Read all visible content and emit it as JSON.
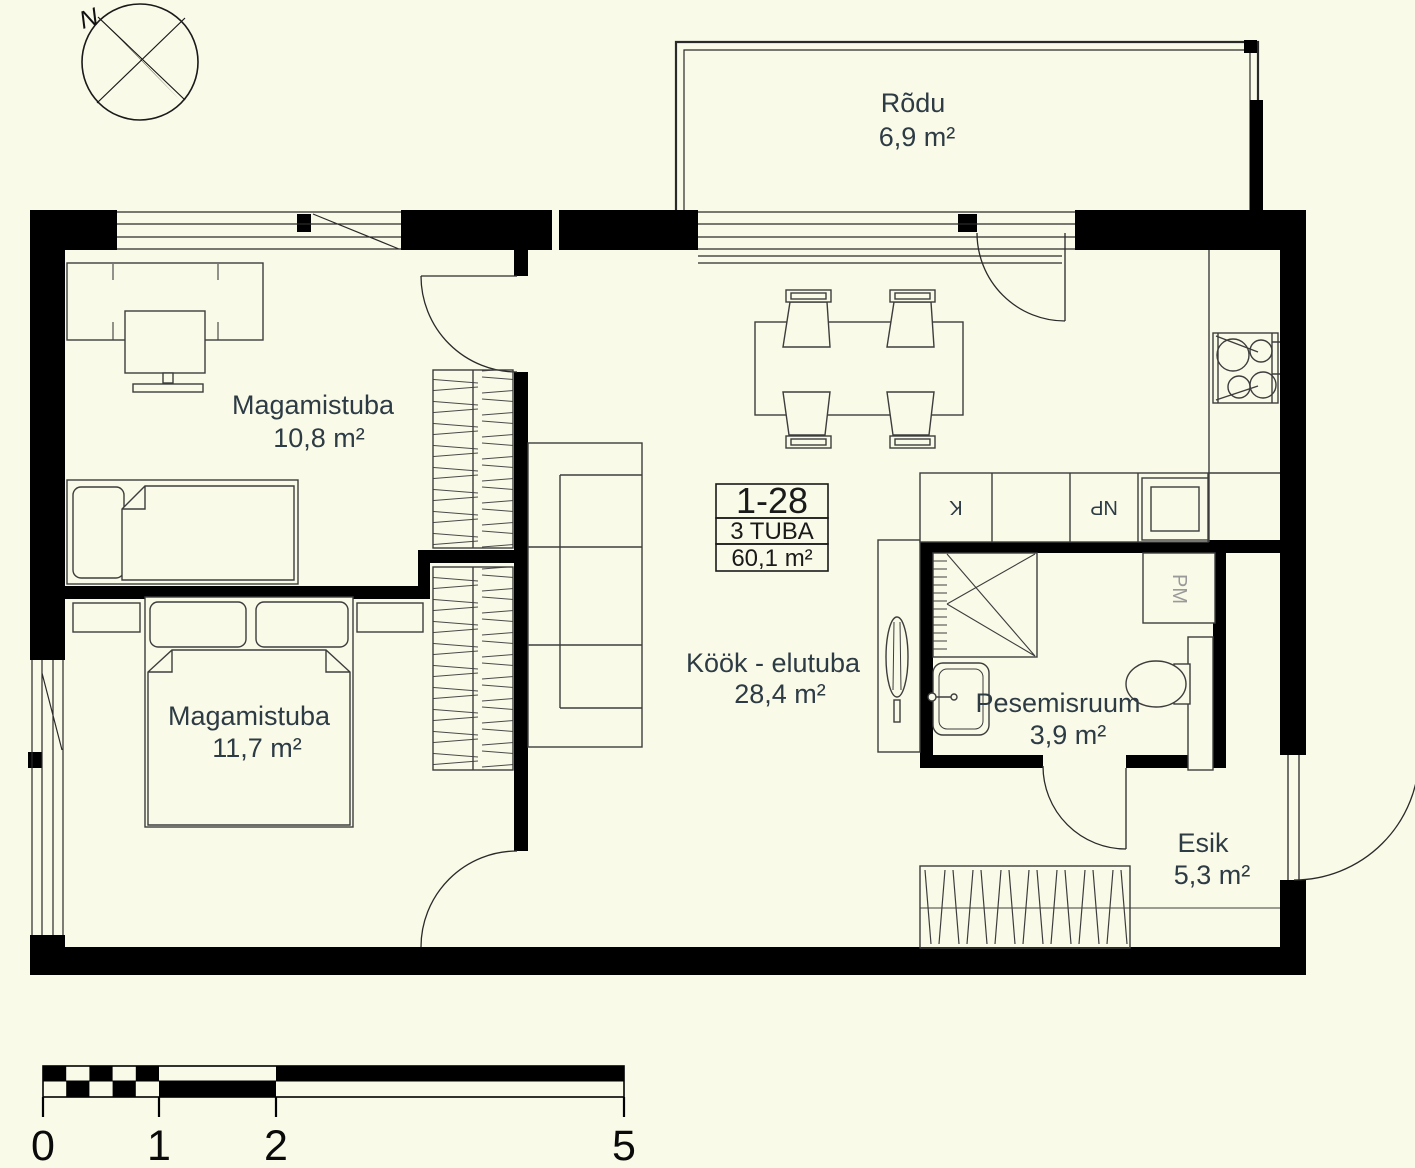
{
  "colors": {
    "background": "#fafae8",
    "wall": "#000000",
    "furniture_line": "#3d3d3d",
    "text": "#2d3b45",
    "muted_label": "#9a9a9a"
  },
  "compass": {
    "north": "N"
  },
  "rooms": {
    "balcony": {
      "name": "Rõdu",
      "area": "6,9 m²"
    },
    "bedroom_top": {
      "name": "Magamistuba",
      "area": "10,8 m²"
    },
    "bedroom_bottom": {
      "name": "Magamistuba",
      "area": "11,7 m²"
    },
    "kitchen_living": {
      "name": "Köök - elutuba",
      "area": "28,4 m²"
    },
    "washroom": {
      "name": "Pesemisruum",
      "area": "3,9 m²"
    },
    "hallway": {
      "name": "Esik",
      "area": "5,3 m²"
    }
  },
  "unit_info": {
    "number": "1-28",
    "rooms": "3 TUBA",
    "area": "60,1 m²"
  },
  "labels": {
    "kitchen_cabinet": "K",
    "dishwasher": "NP",
    "washing_machine": "PM"
  },
  "scale_bar": {
    "tick_0": "0",
    "tick_1": "1",
    "tick_2": "2",
    "tick_5": "5"
  }
}
